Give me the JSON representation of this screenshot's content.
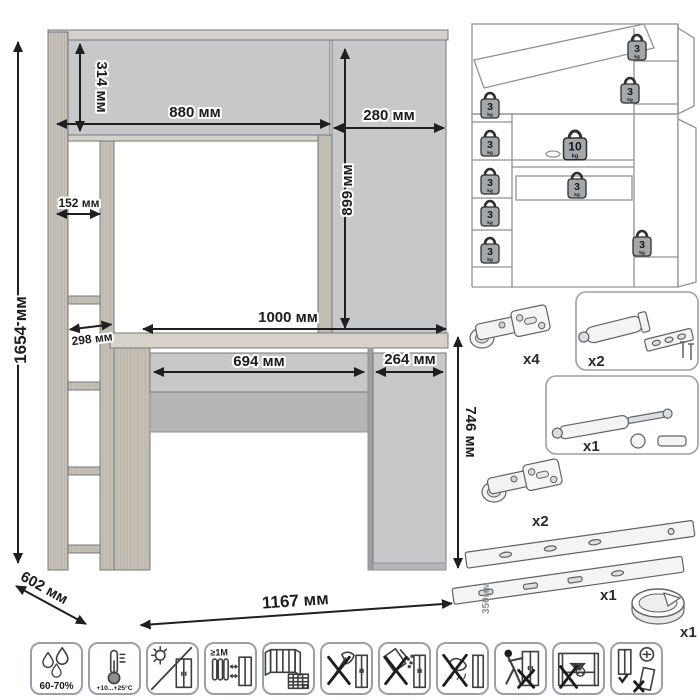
{
  "colors": {
    "panel_gray": "#c6c8ca",
    "wood": "#c9c3b9",
    "outline": "#6b6f73",
    "dimension_text": "#1c1c1c",
    "line_drawing": "#8e9398",
    "weight_fill": "#a4a8ab"
  },
  "dims": {
    "total_height": "1654 мм",
    "hutch_height": "314 мм",
    "hutch_width": "880 мм",
    "top_cab_width": "280 мм",
    "top_cab_height": "899 мм",
    "shelf_width": "152 мм",
    "shelf_depth": "298 мм",
    "desktop_width": "1000 мм",
    "drawer_width": "694 мм",
    "door_width": "264 мм",
    "desk_height": "746 мм",
    "depth": "602 мм",
    "total_width": "1167 мм"
  },
  "load": {
    "weights": [
      {
        "val": "3",
        "unit": "kg"
      },
      {
        "val": "3",
        "unit": "kg"
      },
      {
        "val": "3",
        "unit": "kg"
      },
      {
        "val": "3",
        "unit": "kg"
      },
      {
        "val": "3",
        "unit": "kg"
      },
      {
        "val": "3",
        "unit": "kg"
      },
      {
        "val": "3",
        "unit": "kg"
      },
      {
        "val": "10",
        "unit": "kg"
      },
      {
        "val": "3",
        "unit": "kg"
      },
      {
        "val": "3",
        "unit": "kg"
      }
    ]
  },
  "hardware": {
    "hinge_top_qty": "x4",
    "damper_qty": "x2",
    "gas_lift_qty": "x1",
    "hinge_bottom_qty": "x2",
    "slides_len": "350мм",
    "slides_qty": "x1",
    "grommet_qty": "x1"
  },
  "care": {
    "humidity": "60-70%",
    "temperature": "+10...+25°С",
    "distance": "≥1М",
    "vent_days": "21"
  }
}
